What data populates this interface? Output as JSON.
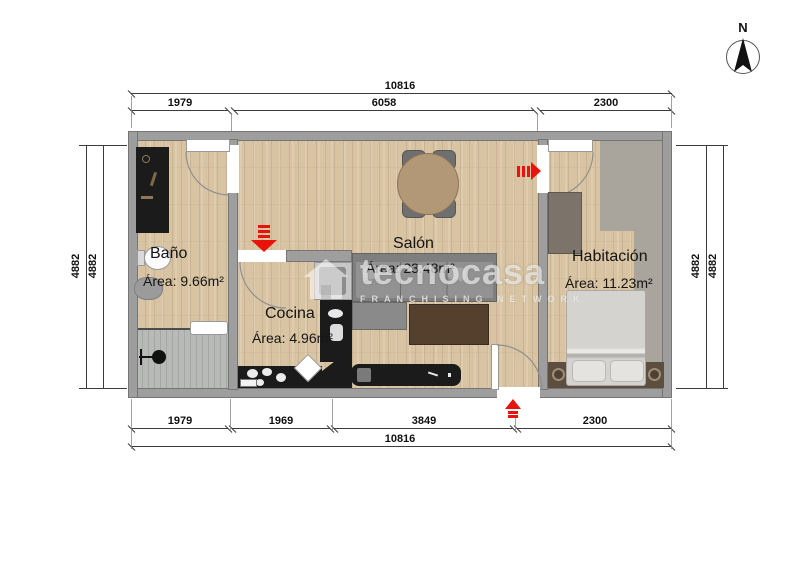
{
  "compass": {
    "label": "N"
  },
  "watermark": {
    "brand": "tecnocasa",
    "subtitle": "FRANCHISING NETWORK"
  },
  "rooms": {
    "bano": {
      "name": "Baño",
      "area": "Área: 9.66m²"
    },
    "cocina": {
      "name": "Cocina",
      "area": "Área: 4.96m²"
    },
    "salon": {
      "name": "Salón",
      "area": "Área: 23.48m²"
    },
    "habitacion": {
      "name": "Habitación",
      "area": "Área: 11.23m²"
    }
  },
  "dims": {
    "top": {
      "overall": "10816",
      "segments": [
        "1979",
        "6058",
        "2300"
      ]
    },
    "bottom": {
      "overall": "10816",
      "segments": [
        "1979",
        "1969",
        "3849",
        "2300"
      ]
    },
    "left": {
      "segments": [
        "4882",
        "4882"
      ]
    },
    "right": {
      "segments": [
        "4882",
        "4882"
      ]
    }
  },
  "colors": {
    "accent_red": "#e8140c",
    "wall_gray": "#9e9e9e",
    "wood_floor": "#d8c4a2"
  }
}
